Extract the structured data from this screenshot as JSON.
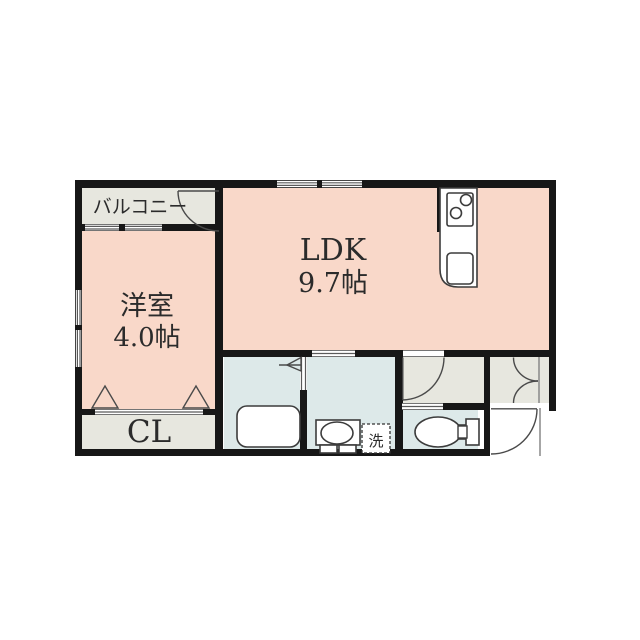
{
  "plan": {
    "rooms": {
      "balcony": {
        "label": "バルコニー"
      },
      "ldk": {
        "label": "LDK",
        "area": "9.7帖"
      },
      "western_room": {
        "label": "洋室",
        "area": "4.0帖"
      },
      "closet": {
        "label": "CL"
      },
      "laundry": {
        "label": "洗"
      }
    },
    "colors": {
      "room_pink": "#f9d8c9",
      "service_grey": "#e7e7df",
      "wet_blue": "#dde9e9",
      "wall_black": "#171717",
      "background": "#ffffff"
    }
  }
}
